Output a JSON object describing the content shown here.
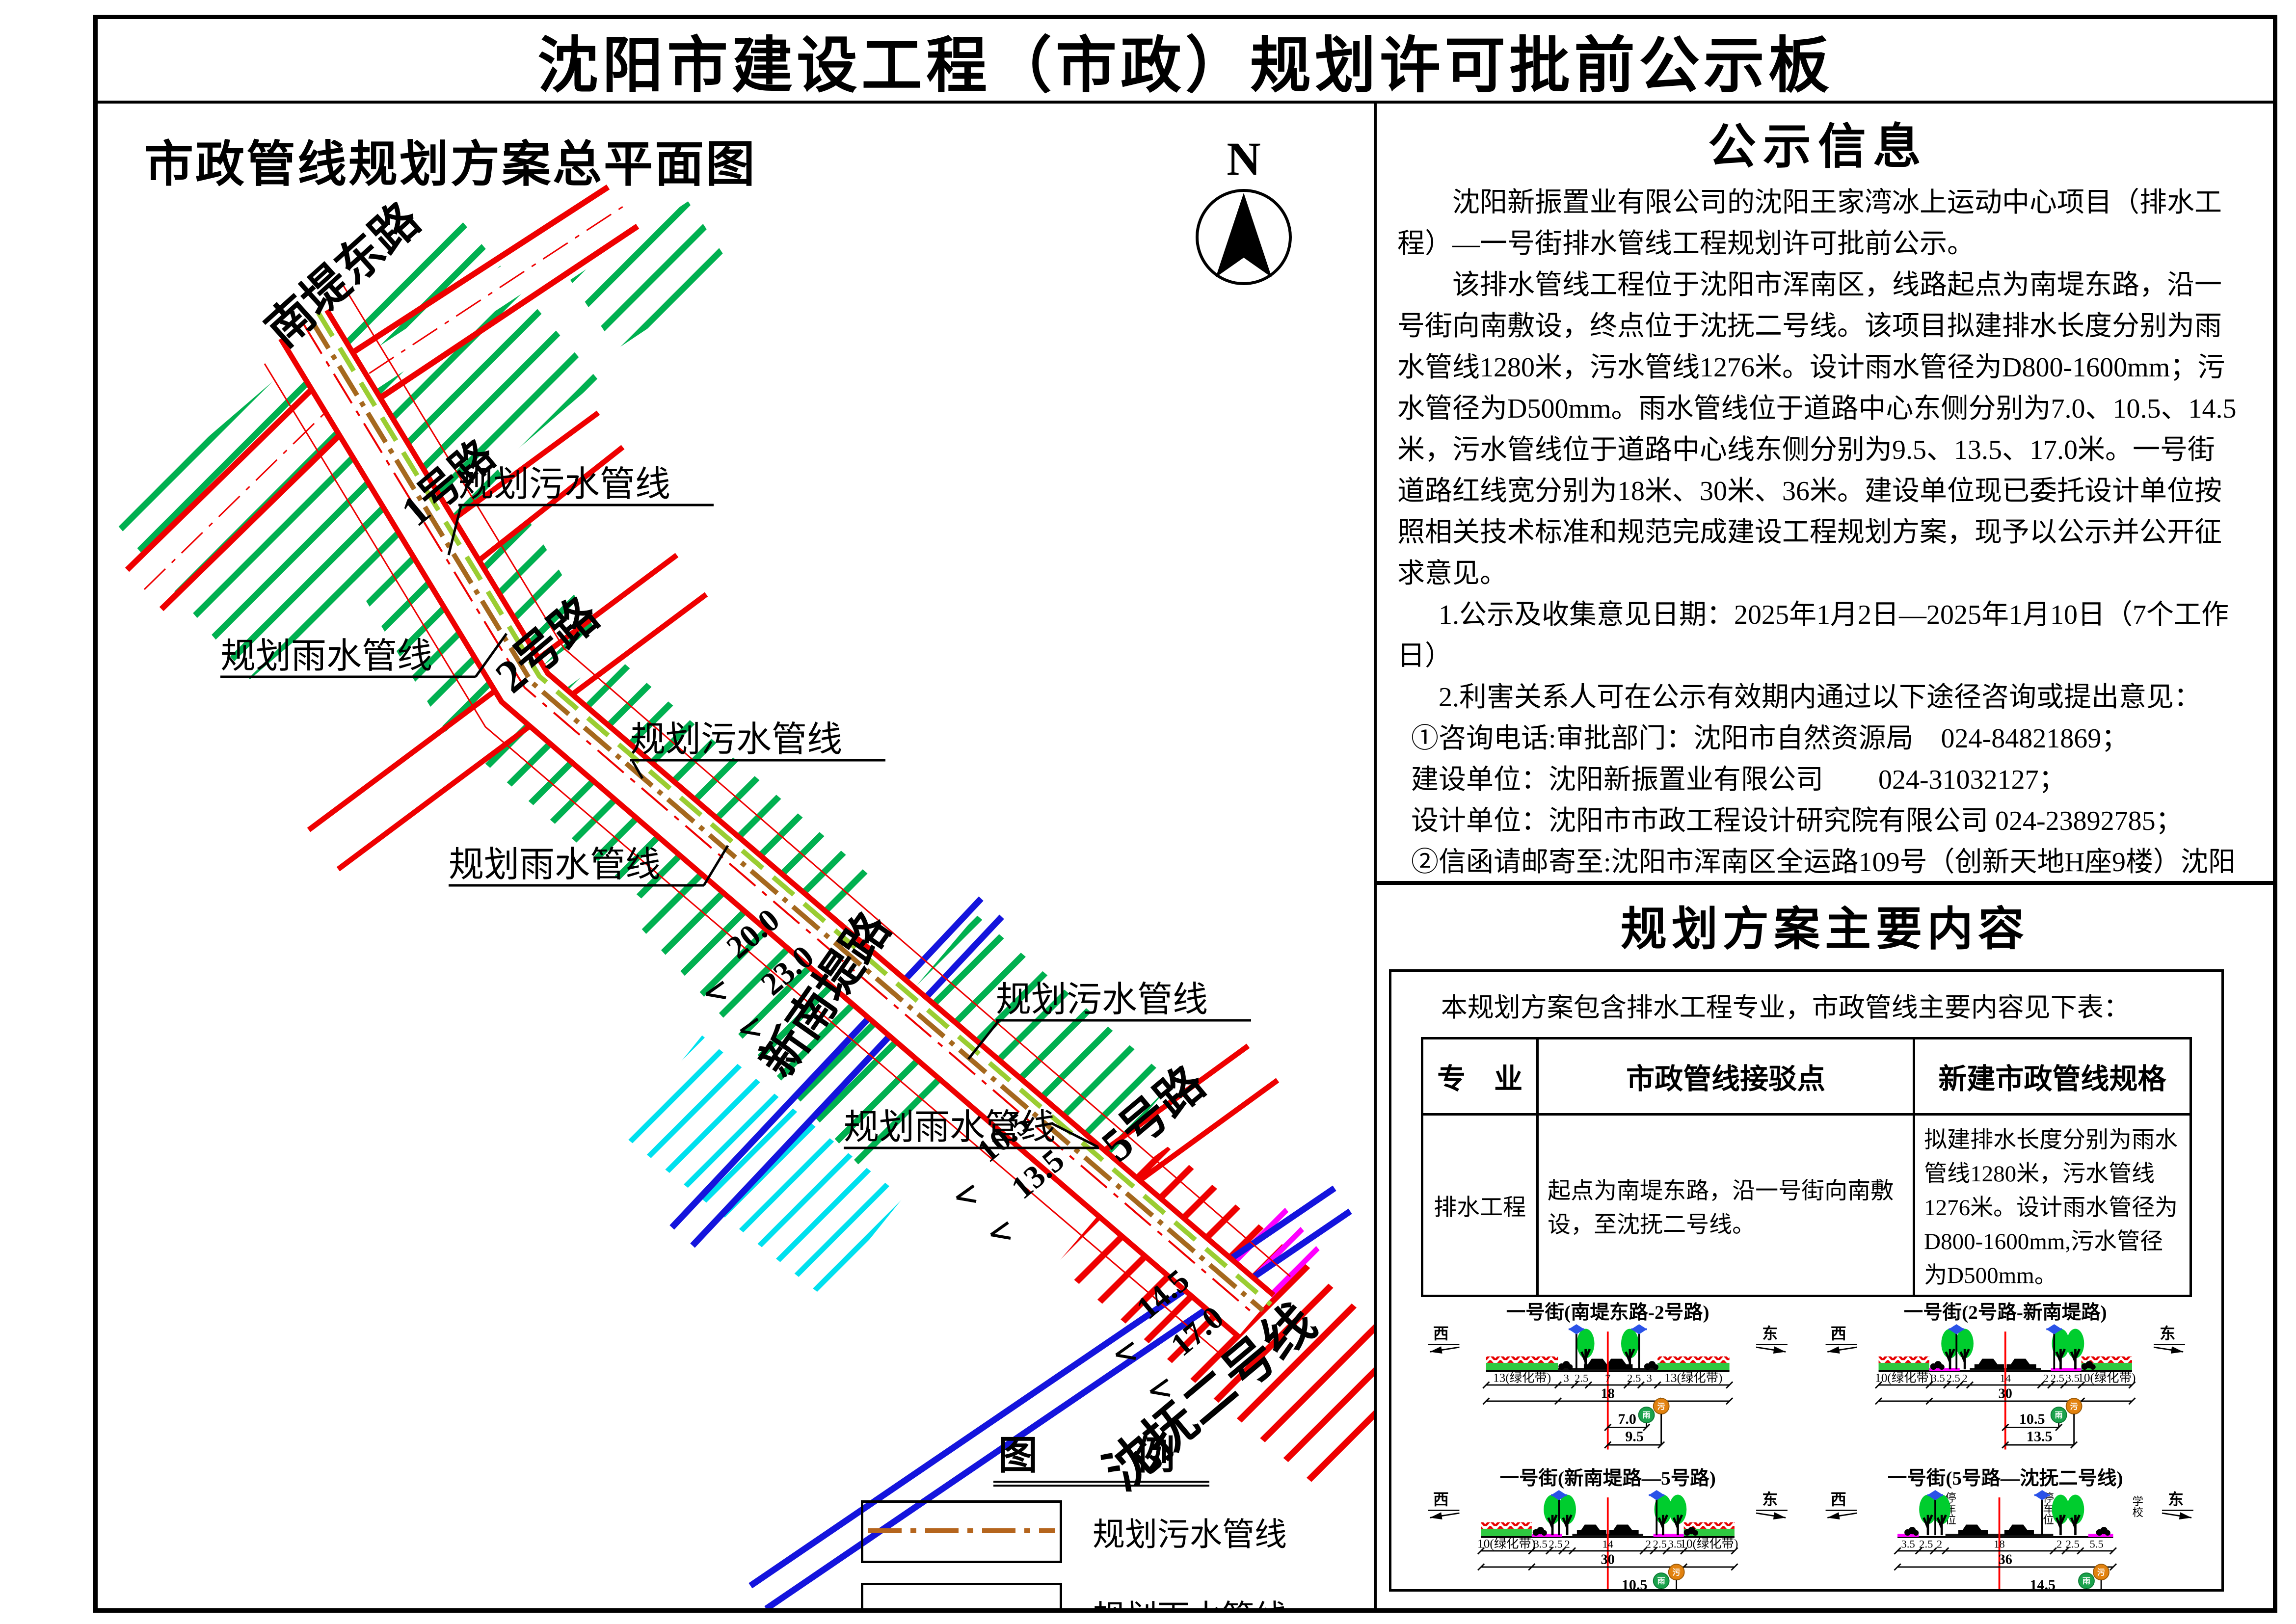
{
  "title": "沈阳市建设工程（市政）规划许可批前公示板",
  "map": {
    "title": "市政管线规划方案总平面图",
    "north": "N",
    "road_nandidong": "南堤东路",
    "road_1hao": "1号路",
    "road_2hao": "2号路",
    "road_xinnandi": "新南堤路",
    "road_5hao": "5号路",
    "road_shenfu": "沈抚二号线",
    "pipe_sewage": "规划污水管线",
    "pipe_rain": "规划雨水管线",
    "dim_20": "20.0",
    "dim_23": "23.0",
    "dim_105": "10.5",
    "dim_135": "13.5",
    "dim_145": "14.5",
    "dim_170": "17.0",
    "colors": {
      "green_hatch": "#00b050",
      "cyan_hatch": "#00e0ee",
      "red": "#ee0000",
      "magenta": "#ff00ff",
      "blue_road": "#1414dd",
      "sewage": "#a5681e",
      "rain": "#9acd32"
    }
  },
  "legend": {
    "title": "图　例",
    "sewage_label": "规划污水管线",
    "rain_label": "规划雨水管线"
  },
  "notice": {
    "title": "公示信息",
    "paragraphs": [
      "沈阳新振置业有限公司的沈阳王家湾冰上运动中心项目（排水工程）—一号街排水管线工程规划许可批前公示。",
      "该排水管线工程位于沈阳市浑南区，线路起点为南堤东路，沿一号街向南敷设，终点位于沈抚二号线。该项目拟建排水长度分别为雨水管线1280米，污水管线1276米。设计雨水管径为D800-1600mm；污水管径为D500mm。雨水管线位于道路中心东侧分别为7.0、10.5、14.5米，污水管线位于道路中心线东侧分别为9.5、13.5、17.0米。一号街道路红线宽分别为18米、30米、36米。建设单位现已委托设计单位按照相关技术标准和规范完成建设工程规划方案，现予以公示并公开征求意见。",
      "1.公示及收集意见日期：2025年1月2日—2025年1月10日（7个工作日）",
      "2.利害关系人可在公示有效期内通过以下途径咨询或提出意见：",
      "①咨询电话:审批部门：沈阳市自然资源局　024-84821869；",
      "建设单位：沈阳新振置业有限公司　　024-31032127；",
      "设计单位：沈阳市市政工程设计研究院有限公司 024-23892785；",
      "②信函请邮寄至:沈阳市浑南区全运路109号（创新天地H座9楼）沈阳市自然资源局浑南分局审批科(以邮戳日期为准)。邮编：110167。",
      "③电子邮箱：hnspk-zrzyj@shenyang.gov.cn。",
      "3.反馈意见请注明联系人真实姓名、电话、地址等信息;如因信息不完整或不真实导致无法核对相关情况的，视为无效意见。",
      "4.本方案涉及的利害关系人依法享有陈述、申辩以及申请听证等权利，逾期未申请则视为放弃上述权利。"
    ],
    "signature": [
      "沈阳市浑南区水务事务服务中心",
      "沈阳市自然资源局",
      "2025年1月2日"
    ]
  },
  "plan": {
    "title": "规划方案主要内容",
    "intro": "本规划方案包含排水工程专业，市政管线主要内容见下表：",
    "table": {
      "h0": "专　业",
      "h1": "市政管线接驳点",
      "h2": "新建市政管线规格",
      "r0": "排水工程",
      "r1": "起点为南堤东路，沿一号街向南敷设，至沈抚二号线。",
      "r2": "拟建排水长度分别为雨水管线1280米，污水管线1276米。设计雨水管径为D800-1600mm,污水管径为D500mm。"
    }
  },
  "sections": [
    {
      "title": "一号街(南堤东路-2号路)",
      "west": "西",
      "east": "东",
      "green_left": "13(绿化带)",
      "green_right": "13(绿化带)",
      "seg_0": "3",
      "seg_1": "2.5",
      "seg_2": "7",
      "seg_3": "2.5",
      "seg_4": "3",
      "total": "18",
      "rain_dim": "7.0",
      "sewage_dim": "9.5",
      "rain_mark": "雨",
      "sewage_mark": "污"
    },
    {
      "title": "一号街(2号路-新南堤路)",
      "west": "西",
      "east": "东",
      "green_left": "10(绿化带)",
      "green_right": "10(绿化带)",
      "seg_0": "3.5",
      "seg_1": "2.5",
      "seg_2": "2",
      "seg_3": "14",
      "seg_4": "2",
      "seg_5": "2.5",
      "seg_6": "3.5",
      "total": "30",
      "rain_dim": "10.5",
      "sewage_dim": "13.5",
      "rain_mark": "雨",
      "sewage_mark": "污"
    },
    {
      "title": "一号街(新南堤路—5号路)",
      "west": "西",
      "east": "东",
      "green_left": "10(绿化带)",
      "green_right": "10(绿化带)",
      "seg_0": "3.5",
      "seg_1": "2.5",
      "seg_2": "2",
      "seg_3": "14",
      "seg_4": "2",
      "seg_5": "2.5",
      "seg_6": "3.5",
      "total": "30",
      "rain_dim": "10.5",
      "sewage_dim": "13.5",
      "rain_mark": "雨",
      "sewage_mark": "污"
    },
    {
      "title": "一号街(5号路—沈抚二号线)",
      "west": "西",
      "east": "东",
      "seg_0": "3.5",
      "seg_1": "2.5",
      "seg_2": "2",
      "seg_3": "18",
      "seg_4": "2",
      "seg_5": "2.5",
      "seg_6": "5.5",
      "total": "36",
      "rain_dim": "14.5",
      "sewage_dim": "17.0",
      "rain_mark": "雨",
      "sewage_mark": "污",
      "parking": "停车位",
      "school": "学校"
    }
  ]
}
